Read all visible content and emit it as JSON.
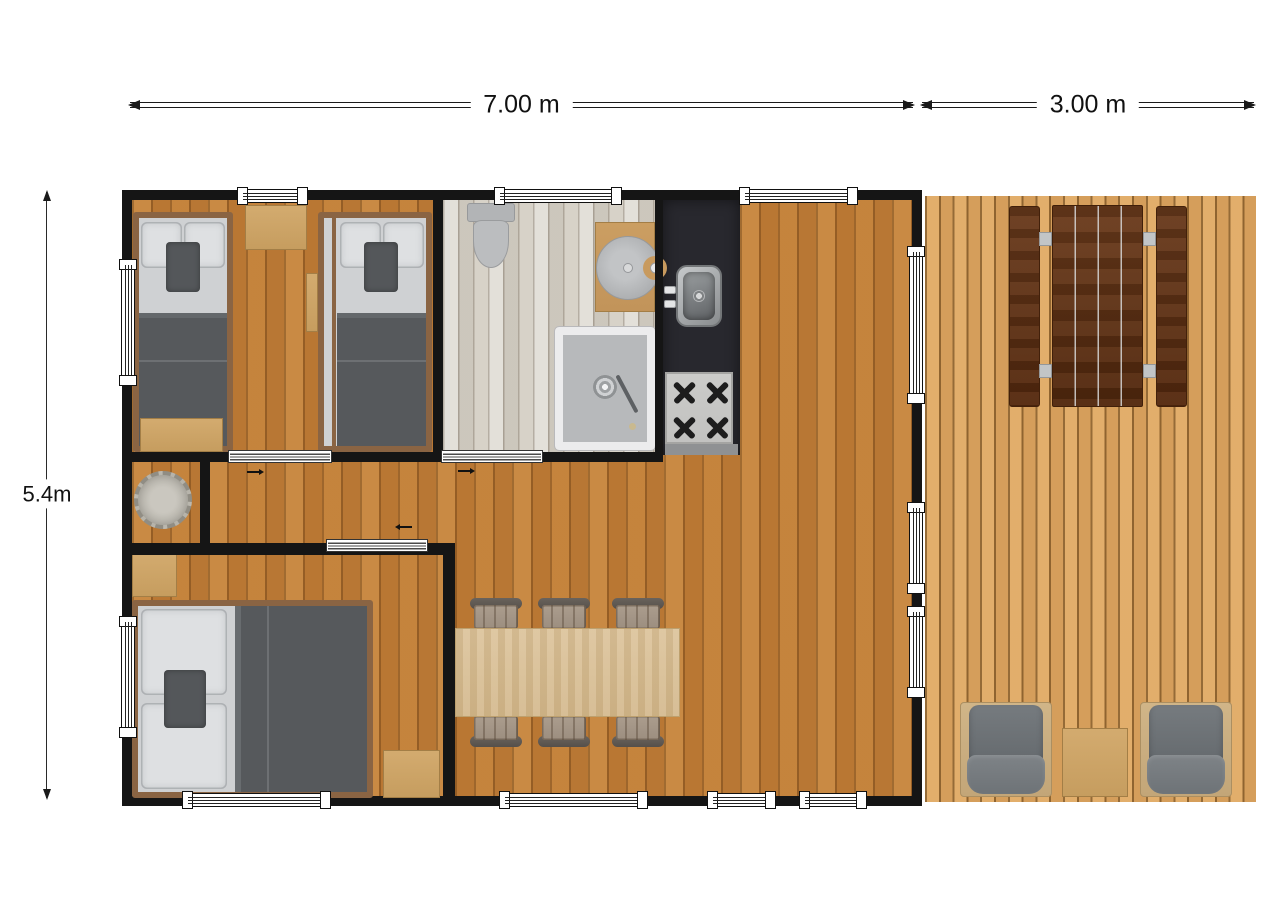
{
  "dim_labels": {
    "main_width": "7.00 m",
    "deck_width": "3.00 m",
    "total_height": "5.4m"
  },
  "colors": {
    "wall": "#151515",
    "floor_wood": "#c2803a",
    "floor_bath": "#d7d2c9",
    "deck_wood": "#dea764",
    "counter": "#28282e",
    "trim": "#8a6443",
    "table_wood": "#dcc39b",
    "chair_wood": "#ab9d8e",
    "mattress": "#cfd1d3",
    "pillow": "#dee0e2",
    "blanket": "#56595c",
    "accent_pillow": "#54575a"
  },
  "rooms": {
    "twin_bedroom": {
      "furniture": [
        "single-bed",
        "single-bed",
        "bedside-table",
        "wall-shelf",
        "foot-bench"
      ]
    },
    "bathroom": {
      "furniture": [
        "toilet",
        "washbasin-counter",
        "round-washbasin",
        "shower"
      ]
    },
    "kitchen": {
      "furniture": [
        "dark-counter",
        "kitchen-sink",
        "stove-four-burners"
      ]
    },
    "hallway": {
      "furniture": [
        "round-rug"
      ]
    },
    "master_bedroom": {
      "furniture": [
        "double-bed",
        "nightstand",
        "nightstand"
      ]
    },
    "living_dining": {
      "furniture": [
        "dining-table",
        "dining-chair",
        "dining-chair",
        "dining-chair",
        "dining-chair",
        "dining-chair",
        "dining-chair"
      ]
    },
    "deck": {
      "furniture": [
        "picnic-bench",
        "picnic-table",
        "picnic-bench",
        "lounge-armchair",
        "side-table",
        "lounge-armchair"
      ]
    }
  },
  "openings": {
    "windows": 12,
    "sliding_doors": 3,
    "door_direction_arrows": 3
  }
}
